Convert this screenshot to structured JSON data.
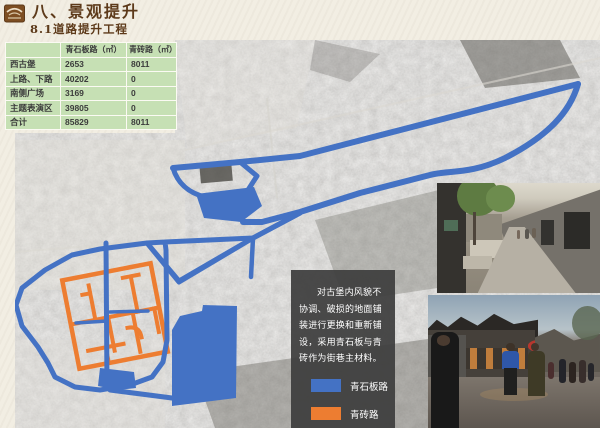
{
  "title": {
    "section": "八、景观提升",
    "subsection": "8.1道路提升工程"
  },
  "table": {
    "headers": [
      "",
      "青石板路（㎡）",
      "青砖路（㎡）"
    ],
    "rows": [
      [
        "西古堡",
        "2653",
        "8011"
      ],
      [
        "上路、下路",
        "40202",
        "0"
      ],
      [
        "南侧广场",
        "3169",
        "0"
      ],
      [
        "主题表演区",
        "39805",
        "0"
      ],
      [
        "合计",
        "85829",
        "8011"
      ]
    ]
  },
  "note": {
    "text": "对古堡内风貌不协调、破损的地面铺装进行更换和重新铺设，采用青石板与青砖作为街巷主材料。"
  },
  "legend": {
    "items": [
      {
        "label": "青石板路",
        "color": "#4472c4"
      },
      {
        "label": "青砖路",
        "color": "#ed7d31"
      }
    ]
  },
  "colors": {
    "background": "#f2eee3",
    "title": "#5d3a1a",
    "table_green": "#c6e0b4",
    "note_bg": "#3d3d3d",
    "route_blue": "#4472c4",
    "route_orange": "#ed7d31"
  }
}
